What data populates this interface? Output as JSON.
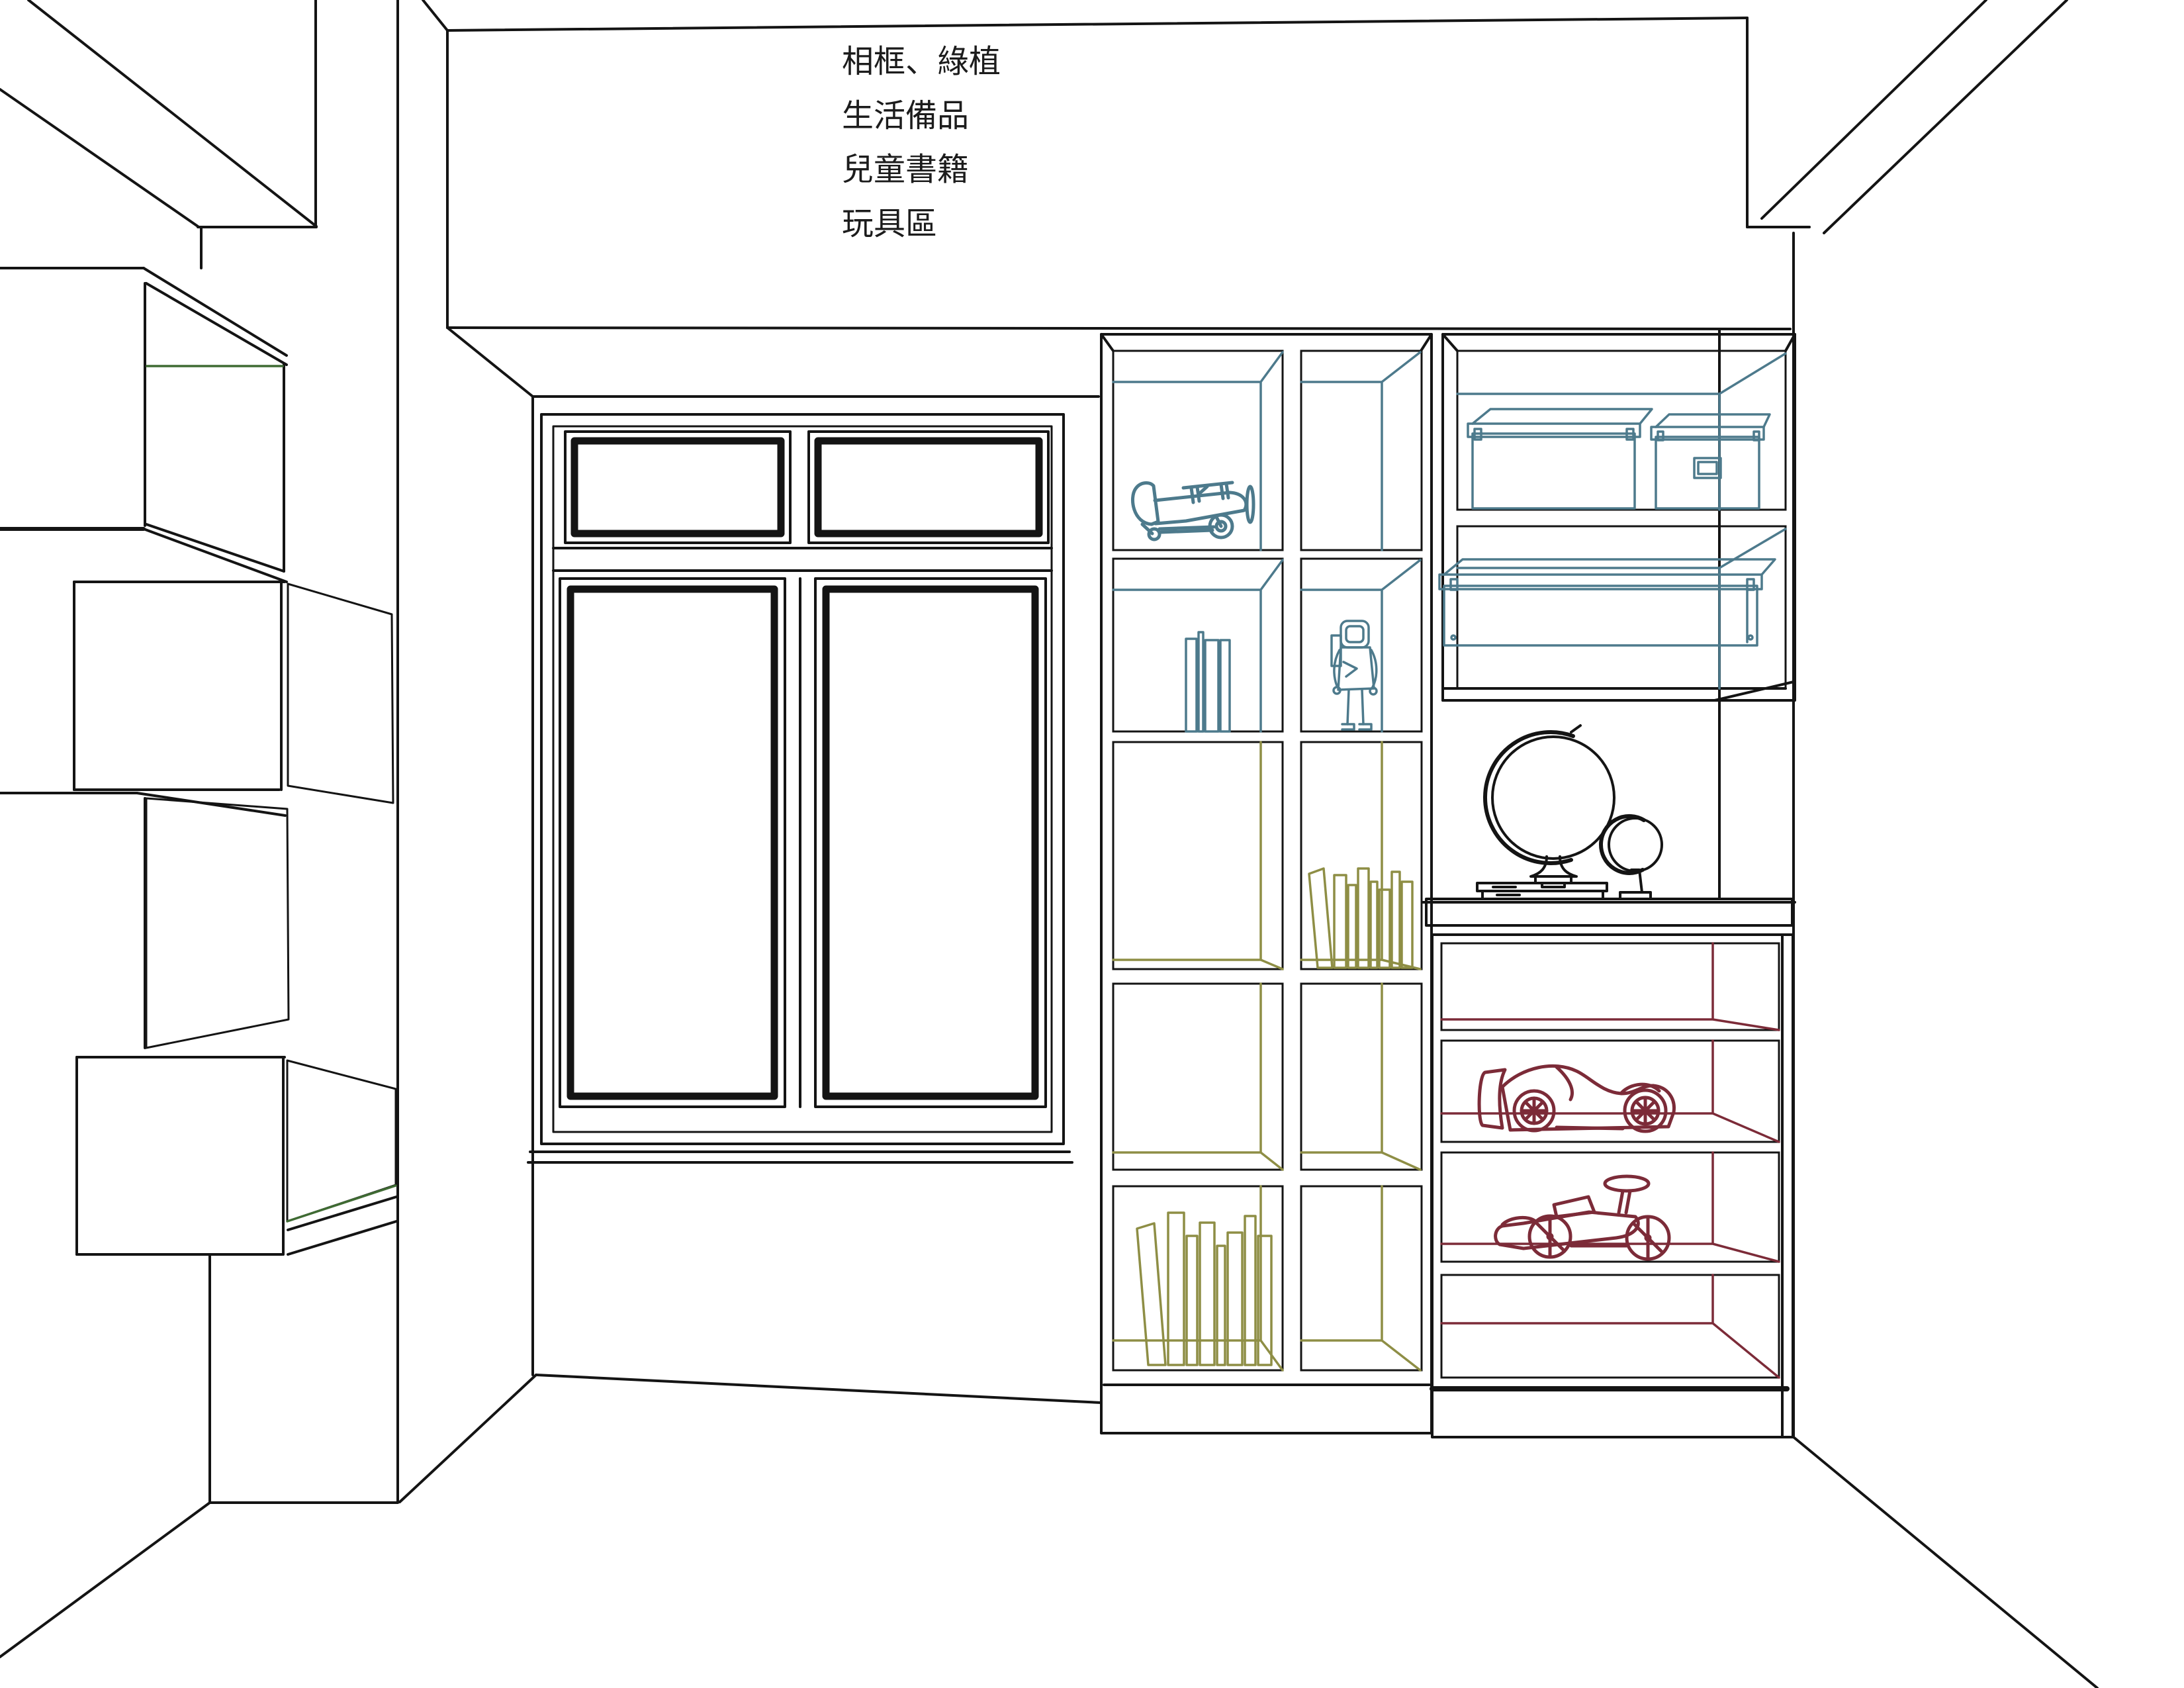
{
  "legend": {
    "items": [
      {
        "id": "frames-plants",
        "label": "相框、綠植",
        "color": "#a9d47b"
      },
      {
        "id": "daily-supplies",
        "label": "生活備品",
        "color": "#c4e5f2"
      },
      {
        "id": "children-books",
        "label": "兒童書籍",
        "color": "#f0ea93"
      },
      {
        "id": "toy-area",
        "label": "玩具區",
        "color": "#f09ca7"
      }
    ]
  },
  "zones": {
    "green_zone_label": "相框、綠植",
    "blue_zone_label": "生活備品",
    "yellow_zone_label": "兒童書籍",
    "pink_zone_label": "玩具區"
  },
  "palette": {
    "green": "#b4da90",
    "blue": "#cfe9f4",
    "yellow": "#f3f1a8",
    "pink": "#f4a8b2",
    "teal": "#4d7a8c",
    "slate": "#4d7586",
    "olive": "#8e8e45",
    "maroon": "#7c2b38",
    "darkgreen": "#3f6b33",
    "line": "#141414"
  }
}
